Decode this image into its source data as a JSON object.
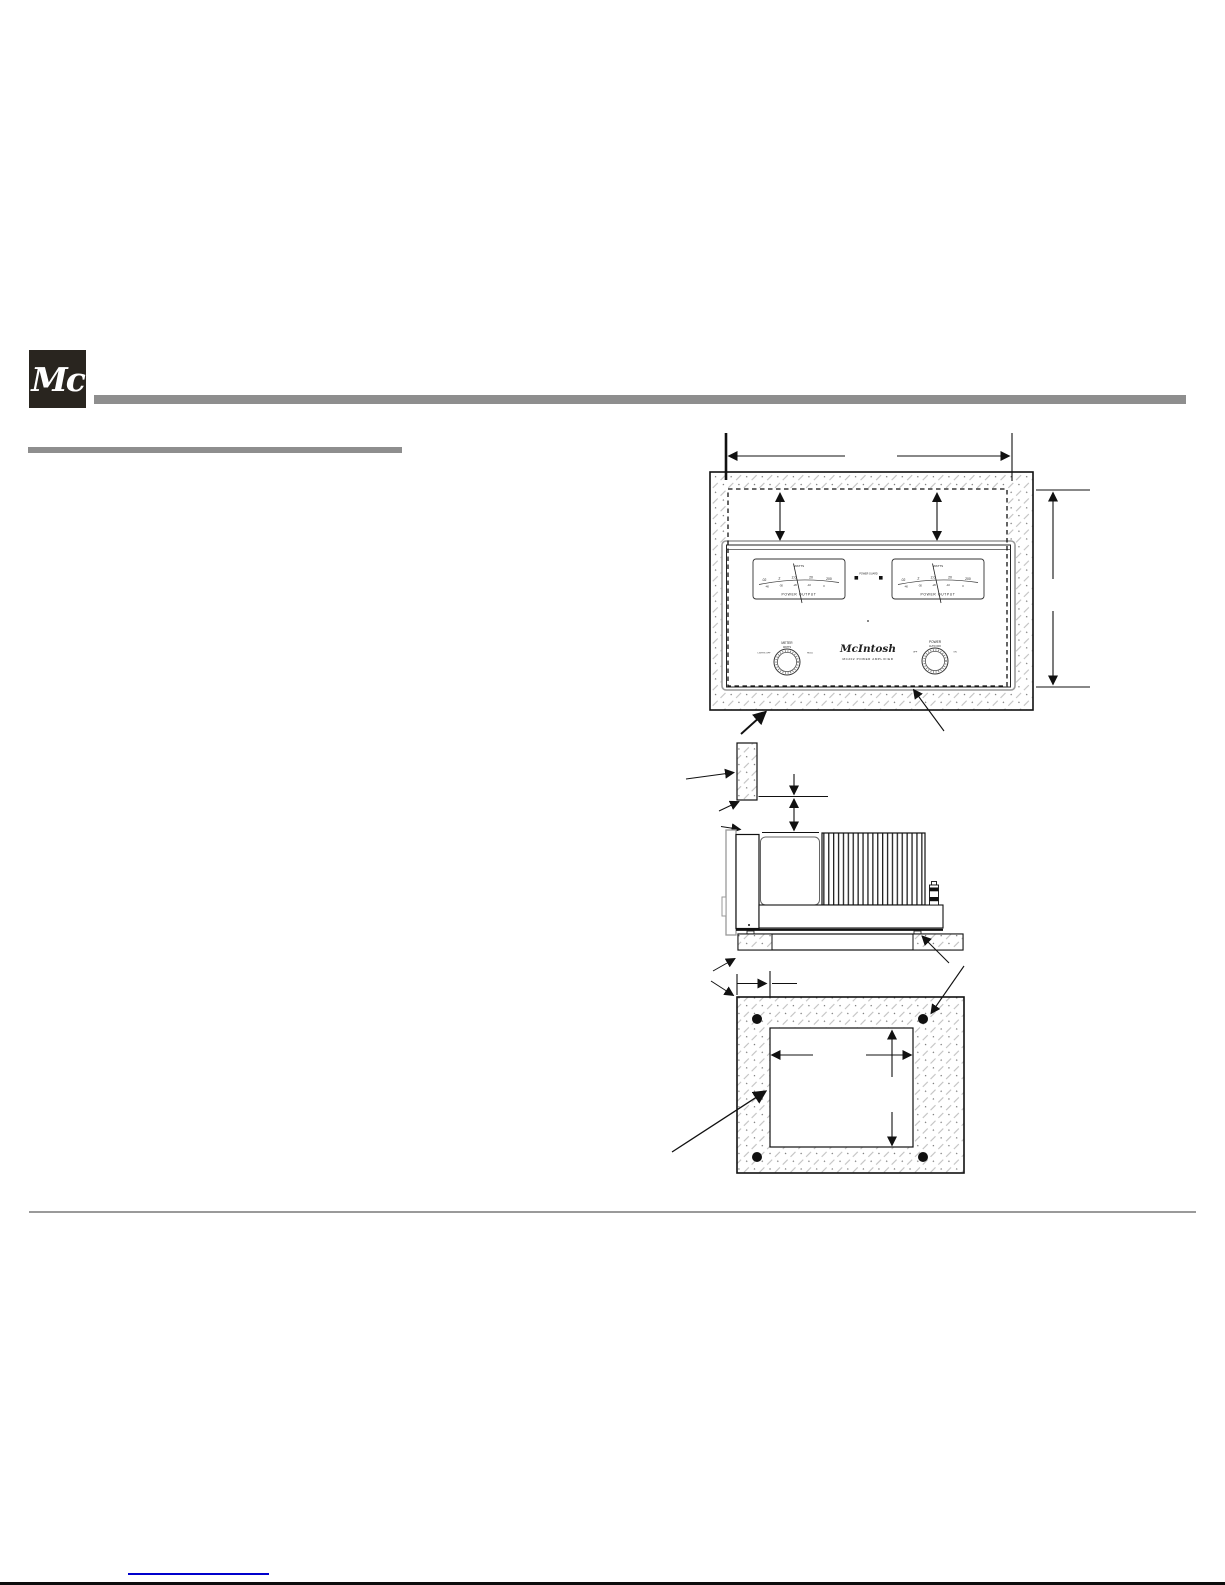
{
  "header": {
    "logo_monogram": "Mc"
  },
  "drawings": {
    "front_view": {
      "brand_script": "McIntosh",
      "model_caption": "MC202 POWER AMPLIFIER",
      "meter": {
        "title": "WATTS",
        "caption": "POWER OUTPUT",
        "scale_watts": [
          ".02",
          ".2",
          "2.0",
          "20",
          "200"
        ],
        "scale_db": [
          "-40",
          "-30",
          "-20",
          "-10",
          "0"
        ]
      },
      "power_guard": {
        "label": "POWER GUARD"
      },
      "meter_knob": {
        "title": "METER",
        "position_top": "WATTS",
        "position_left": "LIGHTS OFF",
        "position_right": "HOLD"
      },
      "power_knob": {
        "title": "POWER",
        "position_top": "AUTO OFF",
        "position_left": "OFF",
        "position_right": "ON"
      }
    }
  },
  "colors": {
    "bar_gray": "#8e8e8e",
    "logo_background": "#29251f",
    "drawing_line": "#111111",
    "hatch_gray": "#c2c2c2",
    "link_blue": "#0000cc"
  }
}
